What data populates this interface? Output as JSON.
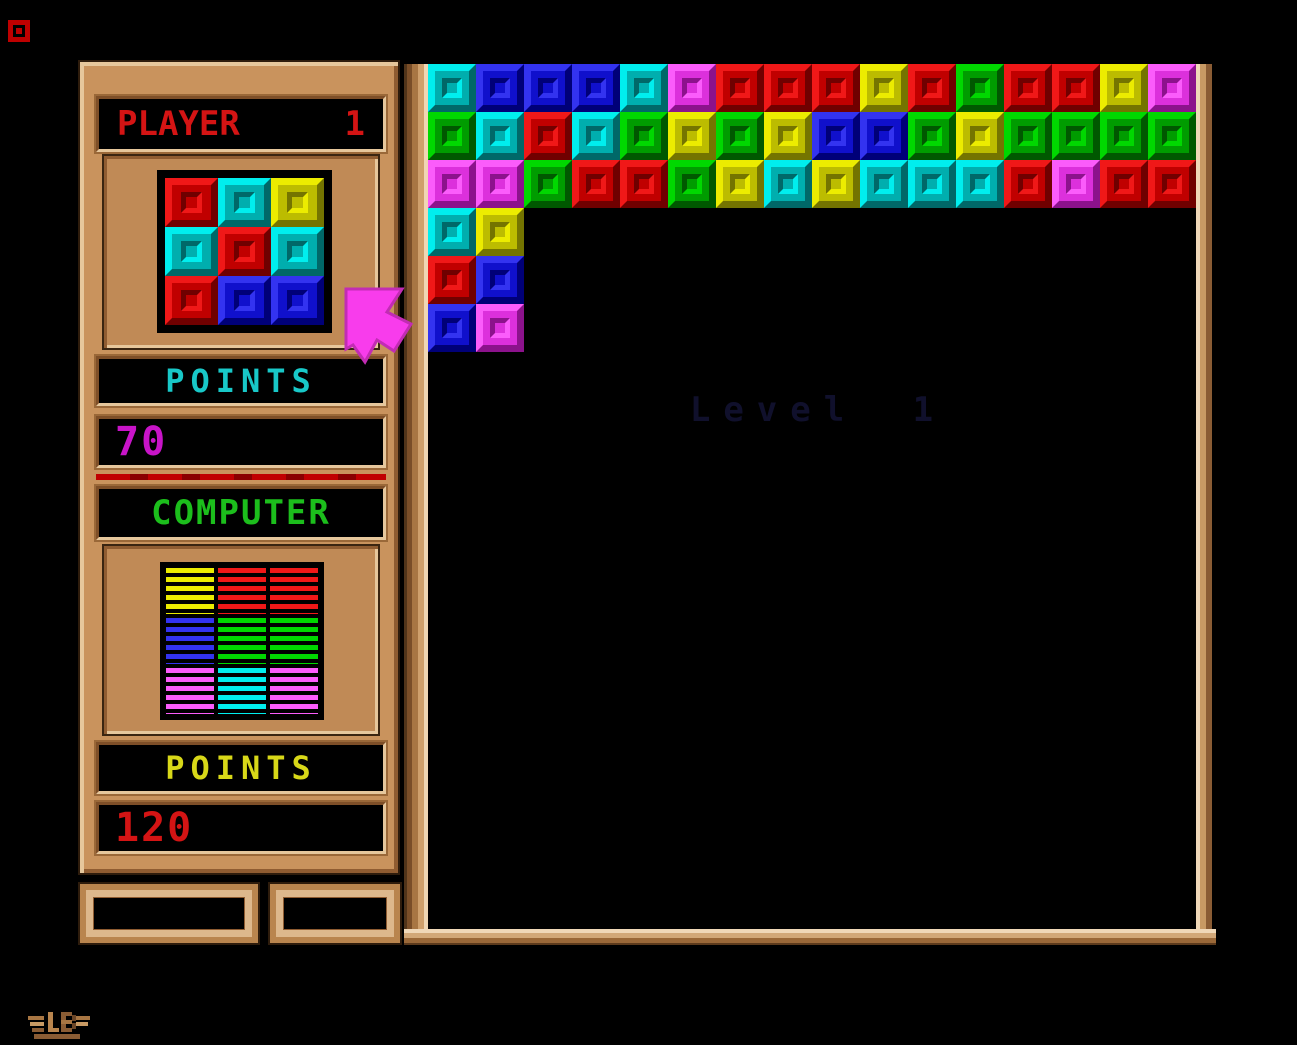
{
  "window": {
    "background": "#000000"
  },
  "system": {
    "menu_icon": "red-block-icon"
  },
  "sidebar": {
    "player": {
      "title": "PLAYER",
      "player_number": "1",
      "points_label": "POINTS",
      "points_value": "70",
      "preview_grid": [
        [
          "red",
          "cyan",
          "yellow"
        ],
        [
          "cyan",
          "red",
          "cyan"
        ],
        [
          "red",
          "blue",
          "blue"
        ]
      ]
    },
    "computer": {
      "title": "COMPUTER",
      "points_label": "POINTS",
      "points_value": "120",
      "board_grid": [
        [
          "yellow",
          "red",
          "red"
        ],
        [
          "blue",
          "green",
          "green"
        ],
        [
          "magenta",
          "cyan",
          "magenta"
        ]
      ]
    }
  },
  "playfield": {
    "level_label": "Level 1",
    "columns": 16,
    "rows": 18,
    "block_size": 48,
    "filled_rows": [
      [
        "cyan",
        "blue",
        "blue",
        "blue",
        "cyan",
        "magenta",
        "red",
        "red",
        "red",
        "yellow",
        "red",
        "green",
        "red",
        "red",
        "yellow",
        "magenta"
      ],
      [
        "green",
        "cyan",
        "red",
        "cyan",
        "green",
        "yellow",
        "green",
        "yellow",
        "blue",
        "blue",
        "green",
        "yellow",
        "green",
        "green",
        "green",
        "green"
      ],
      [
        "magenta",
        "magenta",
        "green",
        "red",
        "red",
        "green",
        "yellow",
        "cyan",
        "yellow",
        "cyan",
        "cyan",
        "cyan",
        "red",
        "magenta",
        "red",
        "red"
      ],
      [
        "cyan",
        "yellow"
      ],
      [
        "red",
        "blue"
      ],
      [
        "blue",
        "magenta"
      ]
    ]
  },
  "cursor": {
    "shape": "magenta-arrow",
    "color": "#F83CEC"
  },
  "colors": {
    "wood_mid": "#C9935D",
    "wood_light": "#E6C79C",
    "wood_dark": "#7E4F28",
    "player_title": "#D41414",
    "points_player": "#18C8C8",
    "score_player": "#C814C8",
    "computer_title": "#1CBE1C",
    "points_computer": "#D8D818",
    "score_computer": "#D41414",
    "level_text": "#10102C",
    "divider": "#C00000",
    "blocks": {
      "red": {
        "l": "#F01818",
        "m": "#C00000",
        "d": "#700000"
      },
      "blue": {
        "l": "#3333F0",
        "m": "#1010CC",
        "d": "#000078"
      },
      "cyan": {
        "l": "#00EEEE",
        "m": "#00AEAE",
        "d": "#006868"
      },
      "green": {
        "l": "#00D800",
        "m": "#009C00",
        "d": "#005800"
      },
      "yellow": {
        "l": "#ECEC00",
        "m": "#BCBC00",
        "d": "#747400"
      },
      "magenta": {
        "l": "#FB5CFB",
        "m": "#DC30DC",
        "d": "#8C128C"
      }
    }
  }
}
